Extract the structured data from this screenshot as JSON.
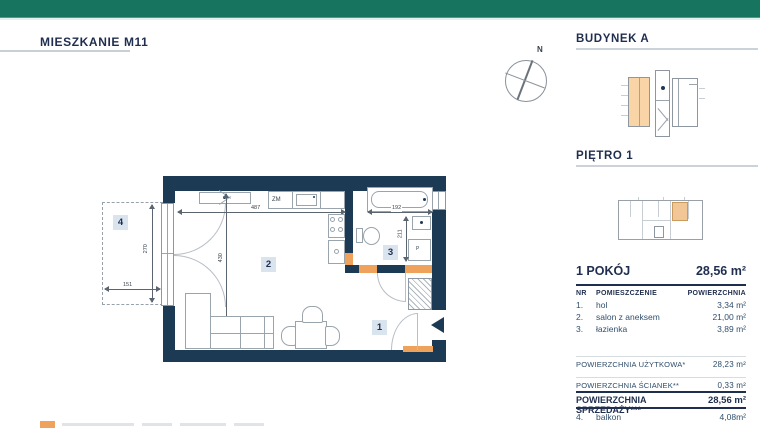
{
  "header": {
    "title": "MIESZKANIE M11"
  },
  "sections": {
    "building_heading": "BUDYNEK A",
    "floor_heading": "PIĘTRO 1"
  },
  "compass": {
    "north": "N"
  },
  "plan": {
    "room_numbers": {
      "hall": "1",
      "salon": "2",
      "bathroom": "3",
      "balcony": "4"
    },
    "equipment_labels": {
      "dishwasher": "ZM",
      "washing_machine": "P"
    },
    "dimensions_cm": {
      "salon_width": "487",
      "salon_height": "430",
      "balcony_height": "270",
      "balcony_width": "151",
      "bathroom_width": "192",
      "bathroom_height": "211"
    }
  },
  "summary": {
    "rooms_title": "1 POKÓJ",
    "total_area": "28,56 m²",
    "columns": {
      "nr": "NR",
      "room": "POMIESZCZENIE",
      "area": "POWIERZCHNIA"
    },
    "rooms": [
      {
        "nr": "1.",
        "name": "hol",
        "area": "3,34 m²"
      },
      {
        "nr": "2.",
        "name": "salon z aneksem",
        "area": "21,00 m²"
      },
      {
        "nr": "3.",
        "name": "łazienka",
        "area": "3,89 m²"
      }
    ],
    "totals": [
      {
        "label": "POWIERZCHNIA UŻYTKOWA*",
        "value": "28,23 m²"
      },
      {
        "label": "POWIERZCHNIA ŚCIANEK**",
        "value": "0,33 m²"
      },
      {
        "label": "POWIERZCHNIA SPRZEDAŻY***",
        "value": "28,56 m²"
      }
    ],
    "balcony_row": {
      "nr": "4.",
      "name": "balkon",
      "area": "4,08m²"
    }
  },
  "colors": {
    "brand_green": "#17755f",
    "navy": "#1d3a55",
    "accent_orange": "#efa25c",
    "highlight_fill": "#f8d4a6",
    "label_box": "#d9e4ee"
  }
}
